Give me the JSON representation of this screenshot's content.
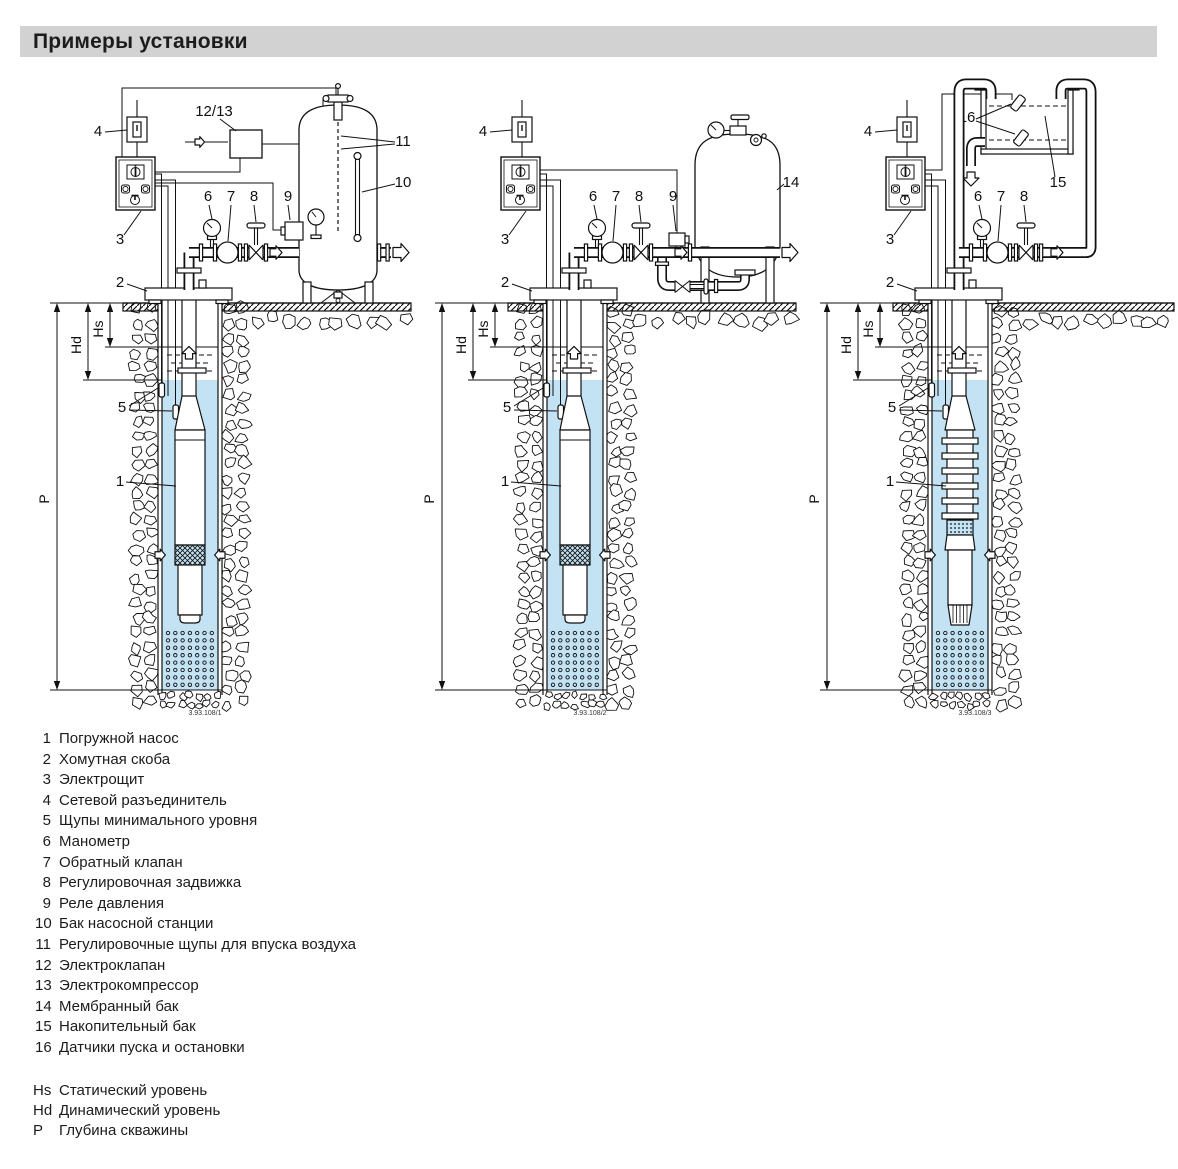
{
  "title": "Примеры установки",
  "colors": {
    "water": "#c3e2f3",
    "title_bg": "#d2d2d2",
    "line": "#111111"
  },
  "dimension_labels": {
    "hs": "Hs",
    "hd": "Hd",
    "p": "P"
  },
  "diagrams": [
    {
      "name": "installation-with-pump-station-tank",
      "figure_number": "3.93.108/1",
      "callouts": {
        "c1": "1",
        "c2": "2",
        "c3": "3",
        "c4": "4",
        "c5": "5",
        "c6": "6",
        "c7": "7",
        "c8": "8",
        "c9": "9",
        "c10": "10",
        "c11": "11",
        "c12_13": "12/13"
      }
    },
    {
      "name": "installation-with-diaphragm-tank",
      "figure_number": "3.93.108/2",
      "callouts": {
        "c1": "1",
        "c2": "2",
        "c3": "3",
        "c4": "4",
        "c5": "5",
        "c6": "6",
        "c7": "7",
        "c8": "8",
        "c9": "9",
        "c14": "14"
      }
    },
    {
      "name": "installation-with-storage-tank",
      "figure_number": "3.93.108/3",
      "callouts": {
        "c1": "1",
        "c2": "2",
        "c3": "3",
        "c4": "4",
        "c5": "5",
        "c6": "6",
        "c7": "7",
        "c8": "8",
        "c15": "15",
        "c16": "16"
      }
    }
  ],
  "legend": {
    "items": [
      {
        "num": "1",
        "label": "Погружной насос"
      },
      {
        "num": "2",
        "label": "Хомутная скоба"
      },
      {
        "num": "3",
        "label": "Электрощит"
      },
      {
        "num": "4",
        "label": "Сетевой разъединитель"
      },
      {
        "num": "5",
        "label": "Щупы минимального уровня"
      },
      {
        "num": "6",
        "label": "Манометр"
      },
      {
        "num": "7",
        "label": "Обратный клапан"
      },
      {
        "num": "8",
        "label": "Регулировочная задвижка"
      },
      {
        "num": "9",
        "label": "Реле давления"
      },
      {
        "num": "10",
        "label": "Бак насосной станции"
      },
      {
        "num": "11",
        "label": "Регулировочные щупы для впуска воздуха"
      },
      {
        "num": "12",
        "label": "Электроклапан"
      },
      {
        "num": "13",
        "label": "Электрокомпрессор"
      },
      {
        "num": "14",
        "label": "Мембранный бак"
      },
      {
        "num": "15",
        "label": "Накопительный бак"
      },
      {
        "num": "16",
        "label": "Датчики пуска и остановки"
      }
    ]
  },
  "dimension_legend": [
    {
      "key": "Hs",
      "label": "Статический уровень"
    },
    {
      "key": "Hd",
      "label": "Динамический уровень"
    },
    {
      "key": "Р",
      "label": "Глубина скважины"
    }
  ]
}
